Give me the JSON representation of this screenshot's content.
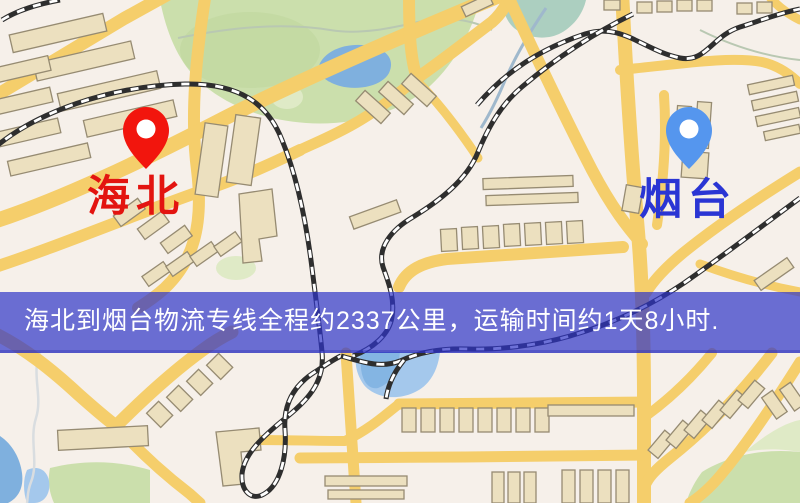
{
  "page": {
    "width": 800,
    "height": 503
  },
  "map": {
    "kind": "logistics-route-map",
    "origin_marker": {
      "label": "海北",
      "pin_color": "#f2150d",
      "label_color": "#e31410"
    },
    "destination_marker": {
      "label": "烟台",
      "pin_color": "#5596ee",
      "label_color": "#2a35d4"
    },
    "info_banner": {
      "text": "海北到烟台物流专线全程约2337公里，运输时间约1天8小时.",
      "background_color": "rgba(47,52,200,0.70)",
      "text_color": "#ffffff"
    },
    "palette": {
      "land": "#f6f0ea",
      "road": "#f5ce6b",
      "park": "#cbdfac",
      "water": "#7fb0de",
      "building_fill": "#ece0bf",
      "building_stroke": "#968b72",
      "railway": "#2e2e2e"
    }
  }
}
